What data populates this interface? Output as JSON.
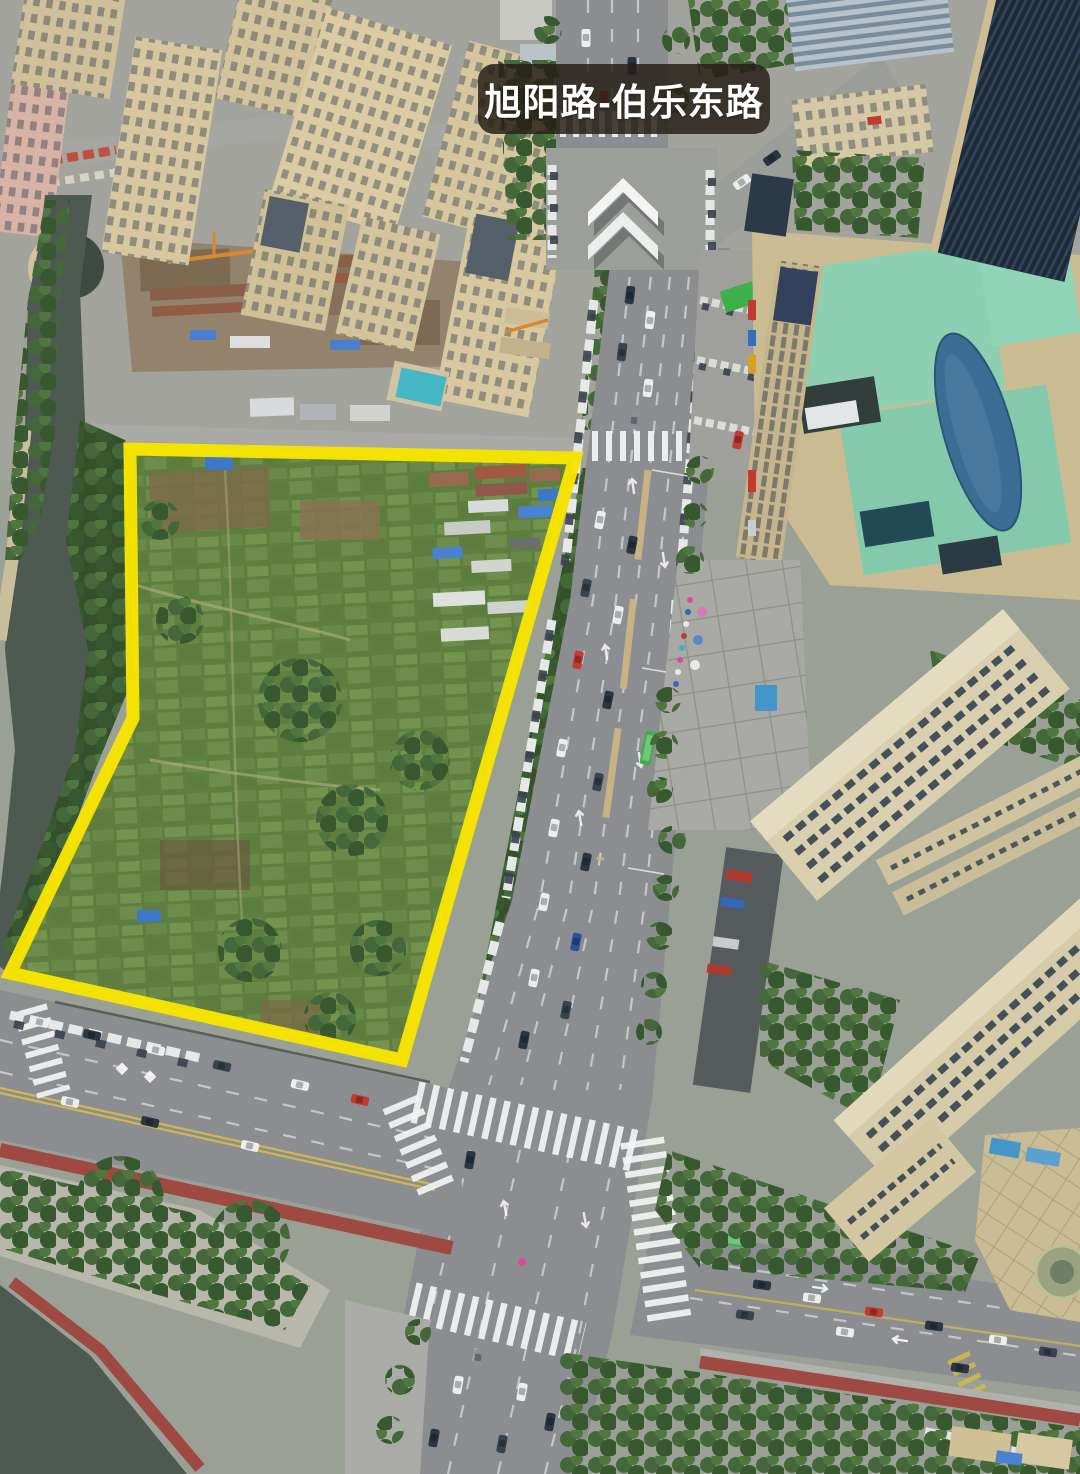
{
  "scene": {
    "type": "aerial-drone-photo",
    "location_label": "旭阳路-伯乐东路",
    "highlighted_parcel": "vacant farmland plot outlined in yellow"
  },
  "colors": {
    "highlight": "#f8e400",
    "label-bg": "rgba(38,31,23,0.84)",
    "label-text": "#ffffff",
    "water": "#4e5a51",
    "asphalt": "#8b8d90",
    "field": "#5f7f41",
    "canopy": "#35512c",
    "tan": "#d3c49c",
    "mint": "#8ccfb2",
    "redpath": "#9e4a42"
  }
}
